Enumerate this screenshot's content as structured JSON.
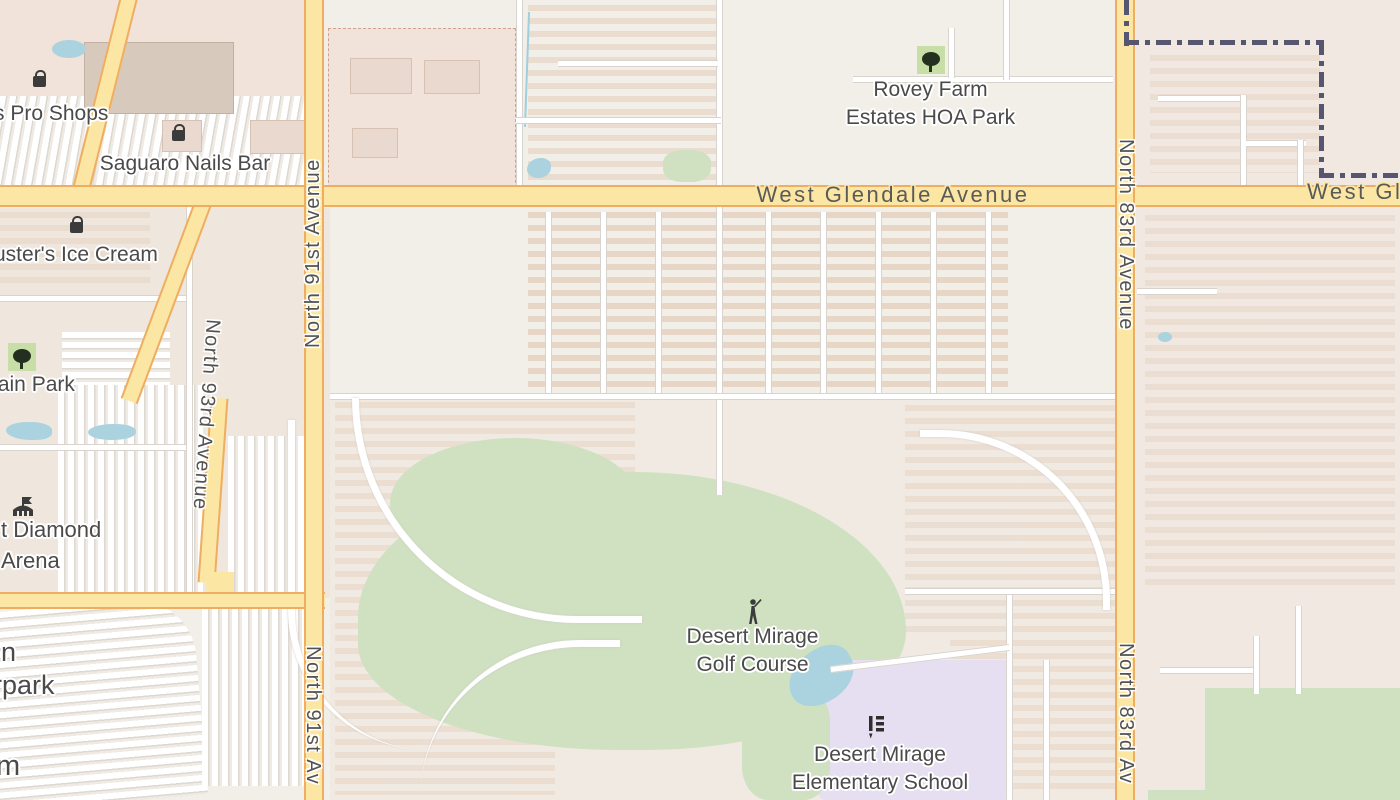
{
  "road_labels": {
    "glendale": "West Glendale Avenue",
    "glendale_truncated": "West Gle",
    "n91st": "North 91st Avenue",
    "n91st_truncated": "North 91st Av",
    "n83rd": "North 83rd Avenue",
    "n83rd_truncated": "North 83rd Av",
    "n93rd": "North 93rd Avenue"
  },
  "pois": {
    "bass_pro": {
      "label": "s Pro Shops",
      "icon": "shopping-bag-icon"
    },
    "saguaro": {
      "label": "Saguaro Nails Bar",
      "icon": "shopping-bag-icon"
    },
    "ice_cream": {
      "label": "uster's Ice Cream",
      "icon": "shopping-bag-icon"
    },
    "mountain_park": {
      "label": "tain Park",
      "icon": "tree-icon"
    },
    "rovey": {
      "line1": "Rovey Farm",
      "line2": "Estates HOA Park",
      "icon": "tree-icon"
    },
    "arena": {
      "line1": "t Diamond",
      "line2": "Arena",
      "icon": "arena-icon"
    },
    "waterpark_fragment": {
      "line1": "n",
      "line2": "rpark"
    },
    "stadium_fragment": {
      "label": "m"
    },
    "golf": {
      "line1": "Desert Mirage",
      "line2": "Golf Course",
      "icon": "golfer-icon"
    },
    "school": {
      "line1": "Desert Mirage",
      "line2": "Elementary School",
      "icon": "school-icon"
    }
  },
  "colors": {
    "background": "#f2efe9",
    "road_major_fill": "#fbe7a3",
    "road_major_casing": "#efad62",
    "road_minor_fill": "#ffffff",
    "road_minor_casing": "#d8d3cc",
    "park_green": "#cfe1c1",
    "water_blue": "#aad3df",
    "school_lavender": "#e6def1",
    "residential_tint": "#efe7de",
    "retail_tint": "#f2e3da",
    "boundary": "#565671",
    "label_text": "#4a4a4a"
  }
}
